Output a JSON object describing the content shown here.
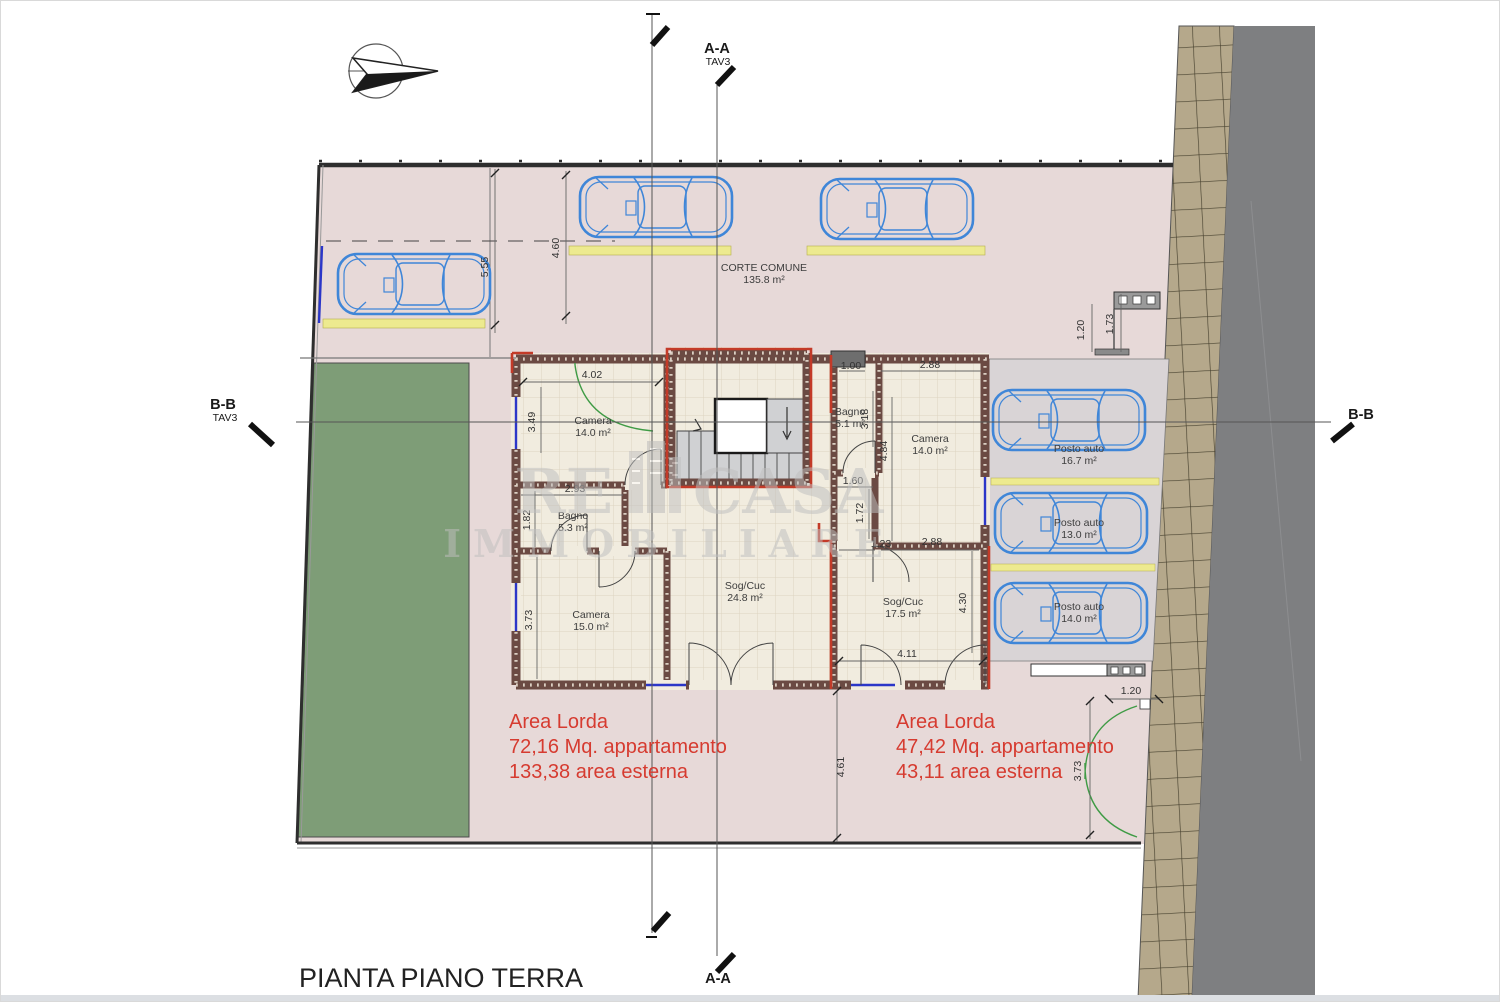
{
  "title": "PIANTA PIANO TERRA",
  "watermark": {
    "re": "RE",
    "casa": "CASA",
    "line2": "IMMOBILIARE"
  },
  "sections": {
    "aa_top": {
      "label": "A-A",
      "sheet": "TAV3"
    },
    "aa_bottom": "A-A",
    "bb_left": {
      "label": "B-B",
      "sheet": "TAV3"
    },
    "bb_right": "B-B"
  },
  "site": {
    "courtyard_label": "CORTE COMUNE",
    "courtyard_area": "135.8 m²"
  },
  "rooms": [
    {
      "name": "Camera",
      "area": "14.0 m²"
    },
    {
      "name": "Bagno",
      "area": "5.3 m²"
    },
    {
      "name": "Camera",
      "area": "15.0 m²"
    },
    {
      "name": "Sog/Cuc",
      "area": "24.8 m²"
    },
    {
      "name": "Bagno",
      "area": "5.1 m²"
    },
    {
      "name": "Camera",
      "area": "14.0 m²"
    },
    {
      "name": "Sog/Cuc",
      "area": "17.5 m²"
    }
  ],
  "parking": [
    {
      "name": "Posto auto",
      "area": "16.7 m²"
    },
    {
      "name": "Posto auto",
      "area": "13.0 m²"
    },
    {
      "name": "Posto auto",
      "area": "14.0 m²"
    }
  ],
  "areas": {
    "left": [
      "Area Lorda",
      "72,16 Mq. appartamento",
      "133,38 area esterna"
    ],
    "right": [
      "Area Lorda",
      "47,42 Mq. appartamento",
      "43,11 area esterna"
    ]
  },
  "dimensions": [
    "5.55",
    "4.60",
    "4.02",
    "3.49",
    "2.93",
    "1.82",
    "3.73",
    "1.00",
    "2.88",
    "3.18",
    "4.84",
    "1.60",
    "1.72",
    "1.23",
    "2.88",
    "4.30",
    "4.11",
    "4.61",
    "1.20",
    "1.73",
    "1.20",
    "3.73"
  ],
  "colors": {
    "site_pink": "#e7d9d8",
    "garden_green": "#7e9d77",
    "sidewalk_tan": "#b5a88b",
    "road_gray": "#7e7f81",
    "floor_cream": "#f1ecdf",
    "wall_brown": "#6b4a43",
    "red_accent": "#c33a28",
    "red_text": "#d63b30",
    "car_blue": "#3f86d8",
    "stall_gray": "#d9d4d6",
    "yellow_strip": "#edea8f"
  }
}
